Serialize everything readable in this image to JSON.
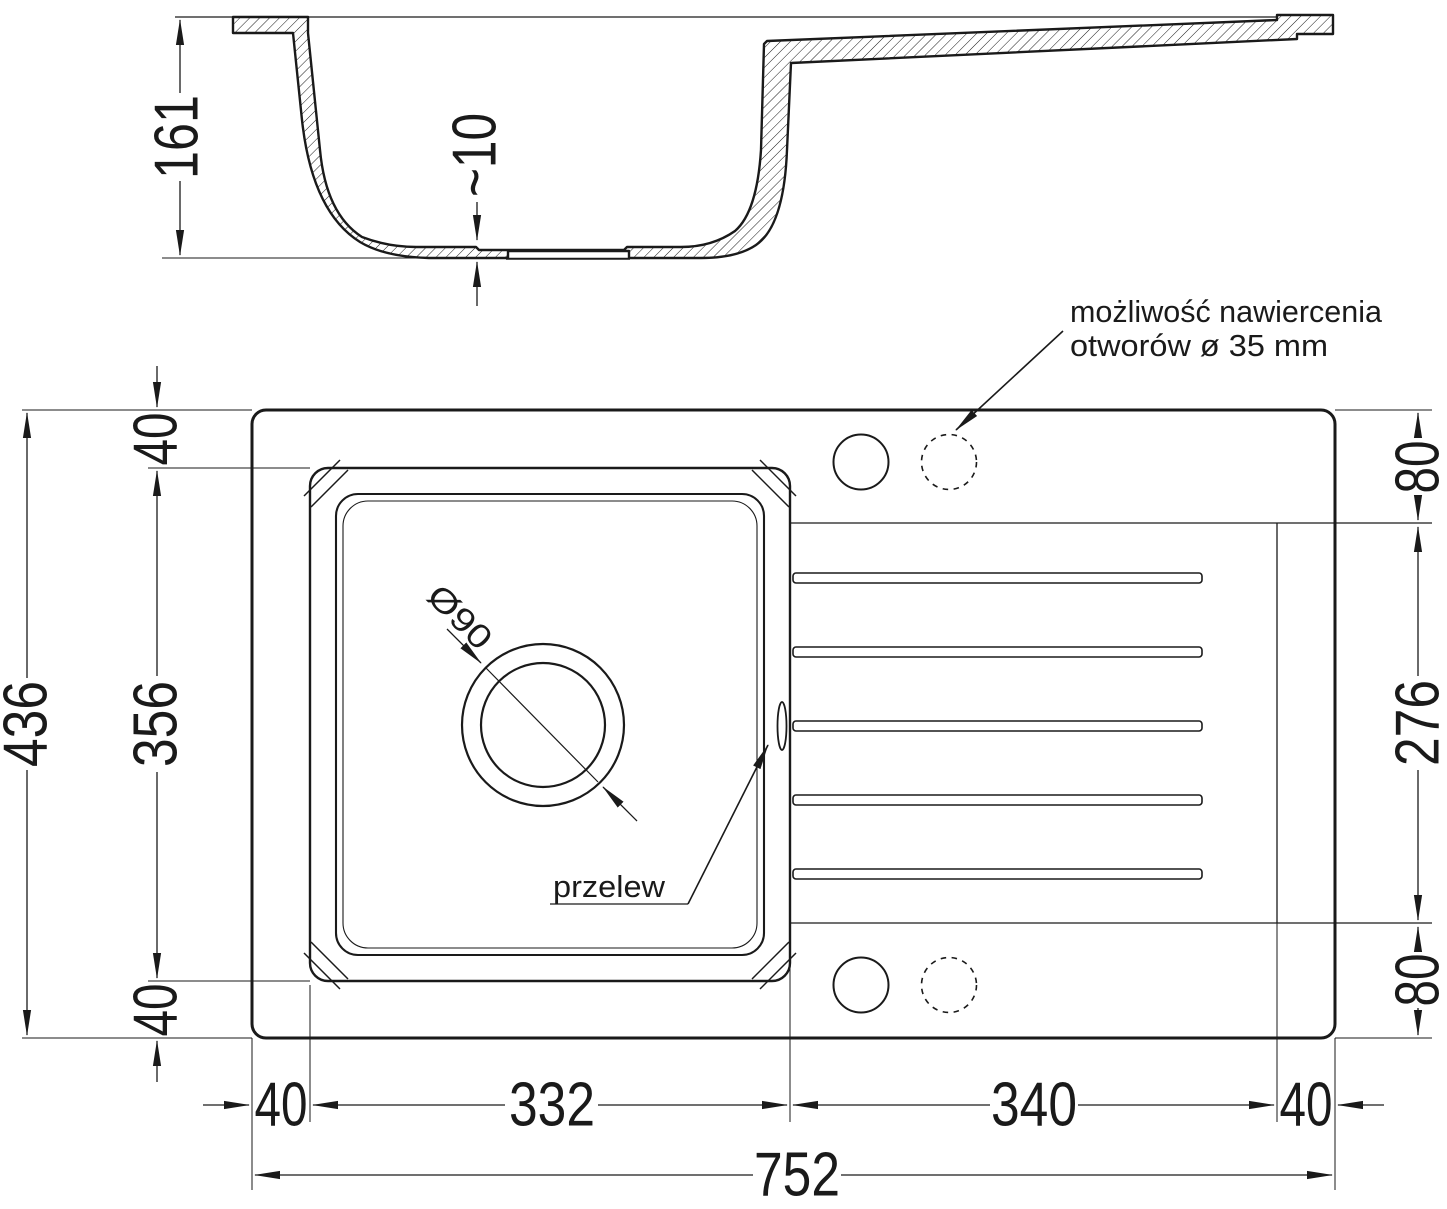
{
  "page": {
    "background": "#ffffff",
    "line_color": "#1a1a1a"
  },
  "cross_section": {
    "depth": "161",
    "bottom_thickness": "~10"
  },
  "plan": {
    "total_width": "752",
    "total_height": "436",
    "bottom_widths": {
      "left_margin": "40",
      "bowl": "332",
      "drainer": "340",
      "right_margin": "40"
    },
    "left_heights": {
      "top_margin": "40",
      "bowl": "356",
      "bottom_margin": "40"
    },
    "right_heights": {
      "top_strip": "80",
      "drainer": "276",
      "bottom_strip": "80"
    },
    "drain_diameter": "Ø90",
    "overflow_label": "przelew",
    "drill_note_line1": "możliwość nawiercenia",
    "drill_note_line2": "otworów ø 35 mm"
  }
}
